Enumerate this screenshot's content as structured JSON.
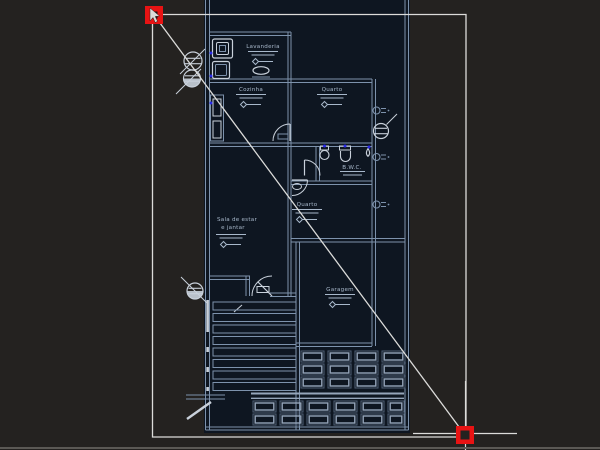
{
  "canvas": {
    "description": "CAD drawing canvas with selected diagonal line and floor plan",
    "background": "#242220",
    "lot_background": "#0e1621"
  },
  "colors": {
    "wall_line": "#7d92ac",
    "bright_line": "#c9d1db",
    "overlay_white": "#dcdcda",
    "grip_red": "#e81313",
    "grip_core": "#1c1a18",
    "fixture_blue": "#2a2ae8",
    "label_text": "#a8b8cb",
    "tile_outer": "#4d5d73",
    "tile_inner": "#95a5ba",
    "bottom_edge": "#5b5955"
  },
  "floorplan": {
    "labels": {
      "lavanderia": "Lavanderia",
      "cozinha": "Cozinha",
      "quarto_top": "Quarto",
      "bwc": "B.W.C.",
      "quarto_bottom": "Quarto",
      "sala_line1": "Sala de estar",
      "sala_line2": "e jantar",
      "garagem": "Garagem"
    }
  },
  "selection": {
    "grips_visible": 2
  }
}
